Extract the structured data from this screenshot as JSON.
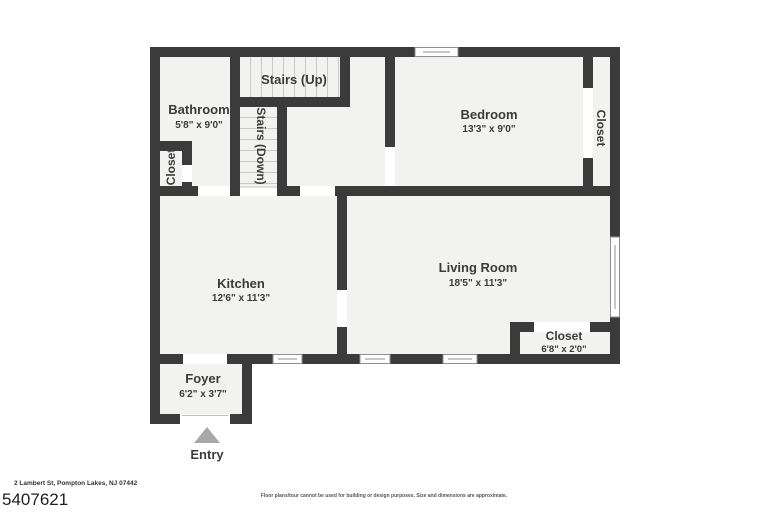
{
  "plan": {
    "rooms": {
      "stairs_up": {
        "label": "Stairs (Up)"
      },
      "bathroom": {
        "label": "Bathroom",
        "dims": "5'8\" x 9'0\""
      },
      "bathroom_closet": {
        "label": "Closet"
      },
      "stairs_down": {
        "label": "Stairs (Down)"
      },
      "bedroom": {
        "label": "Bedroom",
        "dims": "13'3\" x 9'0\""
      },
      "bedroom_closet": {
        "label": "Closet"
      },
      "kitchen": {
        "label": "Kitchen",
        "dims": "12'6\" x 11'3\""
      },
      "living_room": {
        "label": "Living Room",
        "dims": "18'5\" x 11'3\""
      },
      "living_room_closet": {
        "label": "Closet",
        "dims": "6'8\" x 2'0\""
      },
      "foyer": {
        "label": "Foyer",
        "dims": "6'2\" x 3'7\""
      }
    },
    "entry_label": "Entry"
  },
  "footer": {
    "address": "2 Lambert St, Pompton Lakes, NJ 07442",
    "plan_id": "5407621",
    "disclaimer": "Floor plans/tour cannot be used for building or design purposes. Size and dimensions are approximate."
  },
  "colors": {
    "wall": "#3b3b3b",
    "floor": "#f2f2f1",
    "entry_arrow": "#a8a8a8",
    "text": "#3b3b3b"
  }
}
